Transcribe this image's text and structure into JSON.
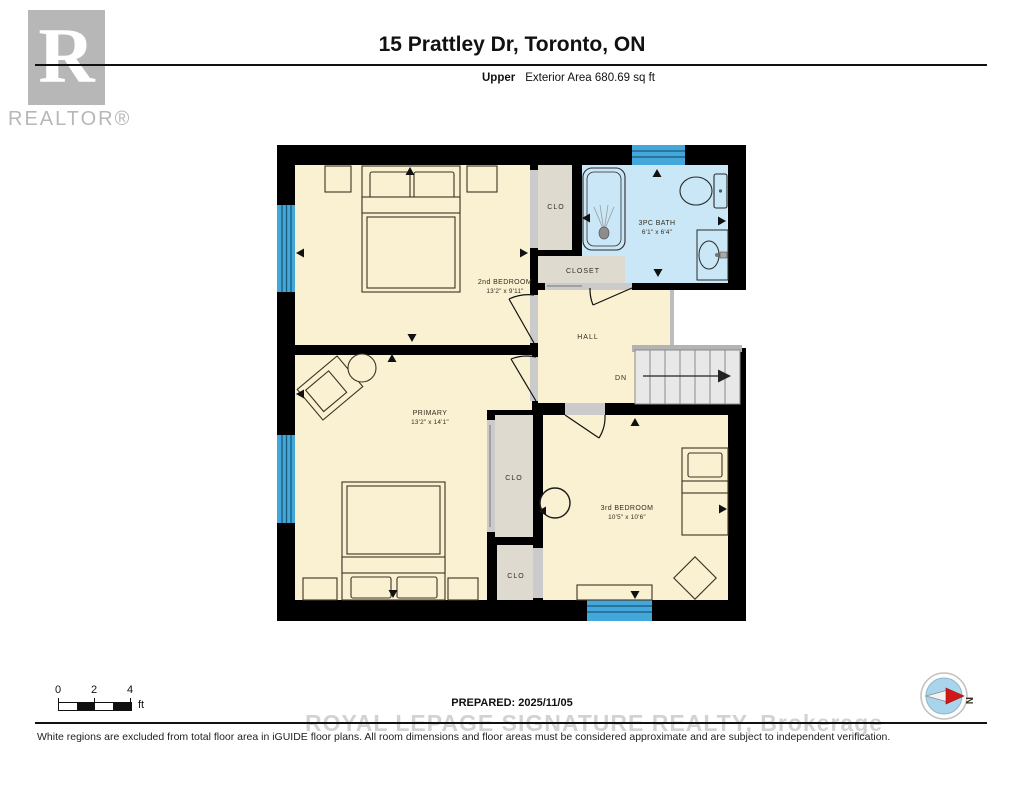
{
  "header": {
    "logo_letter": "R",
    "logo_text": "REALTOR®",
    "title": "15 Prattley Dr, Toronto, ON",
    "floor_label": "Upper",
    "area_label": "Exterior Area 680.69 sq ft"
  },
  "floorplan": {
    "rooms": {
      "bedroom2": {
        "name": "2nd BEDROOM",
        "dims": "13'2\" x 9'11\""
      },
      "primary": {
        "name": "PRIMARY",
        "dims": "13'2\" x 14'1\""
      },
      "bedroom3": {
        "name": "3rd BEDROOM",
        "dims": "10'5\" x 10'6\""
      },
      "bath": {
        "name": "3PC BATH",
        "dims": "6'1\" x 6'4\""
      },
      "hall": {
        "name": "HALL"
      },
      "closet_top": {
        "name": "CLO"
      },
      "closet_hall": {
        "name": "CLOSET"
      },
      "closet_upper": {
        "name": "CLO"
      },
      "closet_lower": {
        "name": "CLO"
      }
    },
    "stairs_label": "DN",
    "colors": {
      "wall": "#000000",
      "room_fill": "#faf0d2",
      "closet_fill": "#dfdad0",
      "bath_fill": "#c9e7f6",
      "window_blue": "#44a7da",
      "stairs_fill": "#e8e8e8"
    }
  },
  "footer": {
    "scale": {
      "ticks": [
        "0",
        "2",
        "4"
      ],
      "unit": "ft"
    },
    "prepared": "PREPARED: 2025/11/05",
    "watermark": "ROYAL LEPAGE SIGNATURE REALTY, Brokerage",
    "compass_label": "N",
    "disclaimer": "White regions are excluded from total floor area in iGUIDE floor plans. All room dimensions and floor areas must be considered approximate and are subject to independent verification."
  }
}
